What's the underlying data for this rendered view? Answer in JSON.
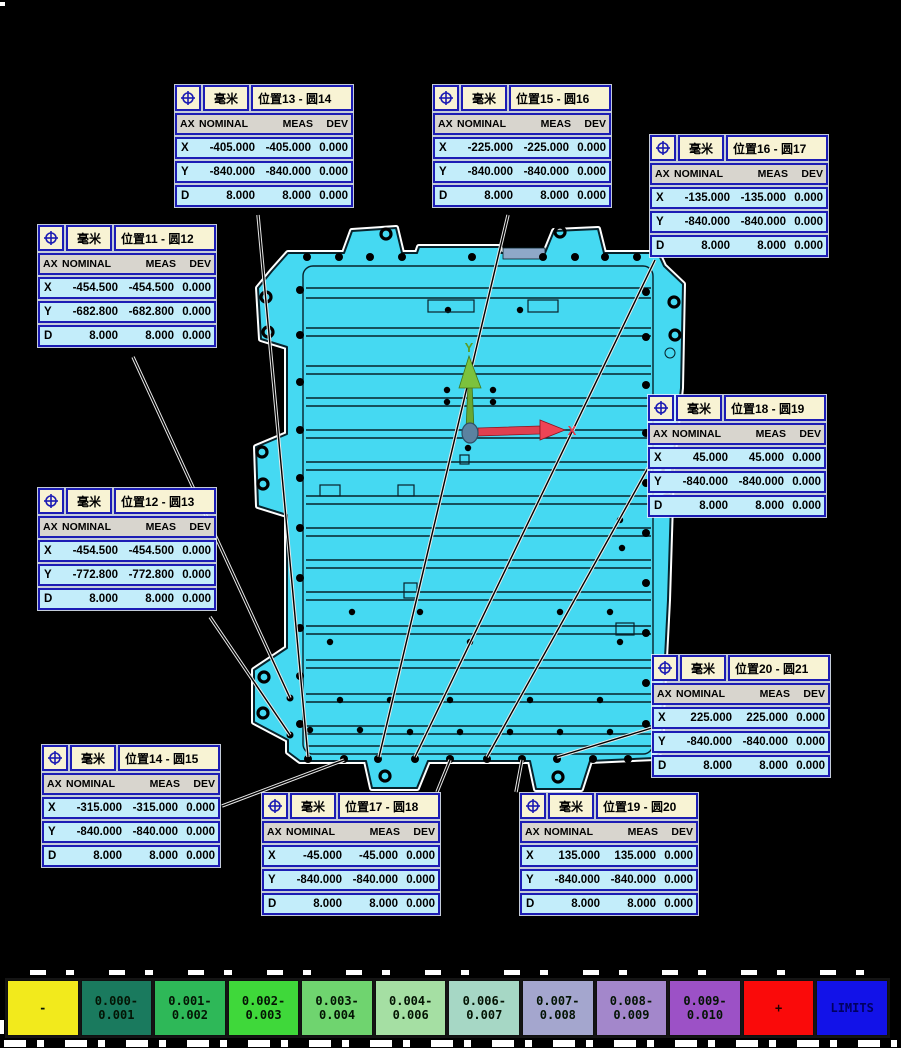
{
  "units_label": "毫米",
  "columns": {
    "ax": "AX",
    "nominal": "NOMINAL",
    "meas": "MEAS",
    "dev": "DEV"
  },
  "axes": {
    "x_label": "X",
    "y_label": "Y"
  },
  "colors": {
    "part_fill": "#45d9f2",
    "part_line": "#07222b",
    "part_glow": "#ffffff",
    "box_border": "#1c1cb4",
    "box_header_bg": "#f8f3d4",
    "box_colhead_bg": "#d8d5ce",
    "box_row_bg": "#c3edfa",
    "axis_x_color": "#e03c4c",
    "axis_y_color": "#5a9e28",
    "background": "#000000"
  },
  "callouts": [
    {
      "id": "pos13-circle14",
      "title": "位置13 - 圆14",
      "rows": [
        [
          "X",
          "-405.000",
          "-405.000",
          "0.000"
        ],
        [
          "Y",
          "-840.000",
          "-840.000",
          "0.000"
        ],
        [
          "D",
          "8.000",
          "8.000",
          "0.000"
        ]
      ]
    },
    {
      "id": "pos15-circle16",
      "title": "位置15 - 圆16",
      "rows": [
        [
          "X",
          "-225.000",
          "-225.000",
          "0.000"
        ],
        [
          "Y",
          "-840.000",
          "-840.000",
          "0.000"
        ],
        [
          "D",
          "8.000",
          "8.000",
          "0.000"
        ]
      ]
    },
    {
      "id": "pos16-circle17",
      "title": "位置16 - 圆17",
      "rows": [
        [
          "X",
          "-135.000",
          "-135.000",
          "0.000"
        ],
        [
          "Y",
          "-840.000",
          "-840.000",
          "0.000"
        ],
        [
          "D",
          "8.000",
          "8.000",
          "0.000"
        ]
      ]
    },
    {
      "id": "pos11-circle12",
      "title": "位置11 - 圆12",
      "rows": [
        [
          "X",
          "-454.500",
          "-454.500",
          "0.000"
        ],
        [
          "Y",
          "-682.800",
          "-682.800",
          "0.000"
        ],
        [
          "D",
          "8.000",
          "8.000",
          "0.000"
        ]
      ]
    },
    {
      "id": "pos12-circle13",
      "title": "位置12 - 圆13",
      "rows": [
        [
          "X",
          "-454.500",
          "-454.500",
          "0.000"
        ],
        [
          "Y",
          "-772.800",
          "-772.800",
          "0.000"
        ],
        [
          "D",
          "8.000",
          "8.000",
          "0.000"
        ]
      ]
    },
    {
      "id": "pos18-circle19",
      "title": "位置18 - 圆19",
      "rows": [
        [
          "X",
          "45.000",
          "45.000",
          "0.000"
        ],
        [
          "Y",
          "-840.000",
          "-840.000",
          "0.000"
        ],
        [
          "D",
          "8.000",
          "8.000",
          "0.000"
        ]
      ]
    },
    {
      "id": "pos20-circle21",
      "title": "位置20 - 圆21",
      "rows": [
        [
          "X",
          "225.000",
          "225.000",
          "0.000"
        ],
        [
          "Y",
          "-840.000",
          "-840.000",
          "0.000"
        ],
        [
          "D",
          "8.000",
          "8.000",
          "0.000"
        ]
      ]
    },
    {
      "id": "pos14-circle15",
      "title": "位置14 - 圆15",
      "rows": [
        [
          "X",
          "-315.000",
          "-315.000",
          "0.000"
        ],
        [
          "Y",
          "-840.000",
          "-840.000",
          "0.000"
        ],
        [
          "D",
          "8.000",
          "8.000",
          "0.000"
        ]
      ]
    },
    {
      "id": "pos17-circle18",
      "title": "位置17 - 圆18",
      "rows": [
        [
          "X",
          "-45.000",
          "-45.000",
          "0.000"
        ],
        [
          "Y",
          "-840.000",
          "-840.000",
          "0.000"
        ],
        [
          "D",
          "8.000",
          "8.000",
          "0.000"
        ]
      ]
    },
    {
      "id": "pos19-circle20",
      "title": "位置19 - 圆20",
      "rows": [
        [
          "X",
          "135.000",
          "135.000",
          "0.000"
        ],
        [
          "Y",
          "-840.000",
          "-840.000",
          "0.000"
        ],
        [
          "D",
          "8.000",
          "8.000",
          "0.000"
        ]
      ]
    }
  ],
  "legend": {
    "items": [
      {
        "label": "-",
        "color": "#f2ea1c",
        "text_color": "#041404"
      },
      {
        "label": "0.000-\n0.001",
        "color": "#1a7a5e",
        "text_color": "#041404"
      },
      {
        "label": "0.001-\n0.002",
        "color": "#2eb858",
        "text_color": "#041404"
      },
      {
        "label": "0.002-\n0.003",
        "color": "#3fd83a",
        "text_color": "#041404"
      },
      {
        "label": "0.003-\n0.004",
        "color": "#6fd46f",
        "text_color": "#041404"
      },
      {
        "label": "0.004-\n0.006",
        "color": "#a5dfa3",
        "text_color": "#041404"
      },
      {
        "label": "0.006-\n0.007",
        "color": "#a6d7c5",
        "text_color": "#041404"
      },
      {
        "label": "0.007-\n0.008",
        "color": "#a4a6ce",
        "text_color": "#041404"
      },
      {
        "label": "0.008-\n0.009",
        "color": "#a387cb",
        "text_color": "#041404"
      },
      {
        "label": "0.009-\n0.010",
        "color": "#9c51c6",
        "text_color": "#041404"
      },
      {
        "label": "+",
        "color": "#fa0a0a",
        "text_color": "#220000"
      },
      {
        "label": "LIMITS",
        "color": "#1212e8",
        "text_color": "#000060"
      }
    ]
  }
}
